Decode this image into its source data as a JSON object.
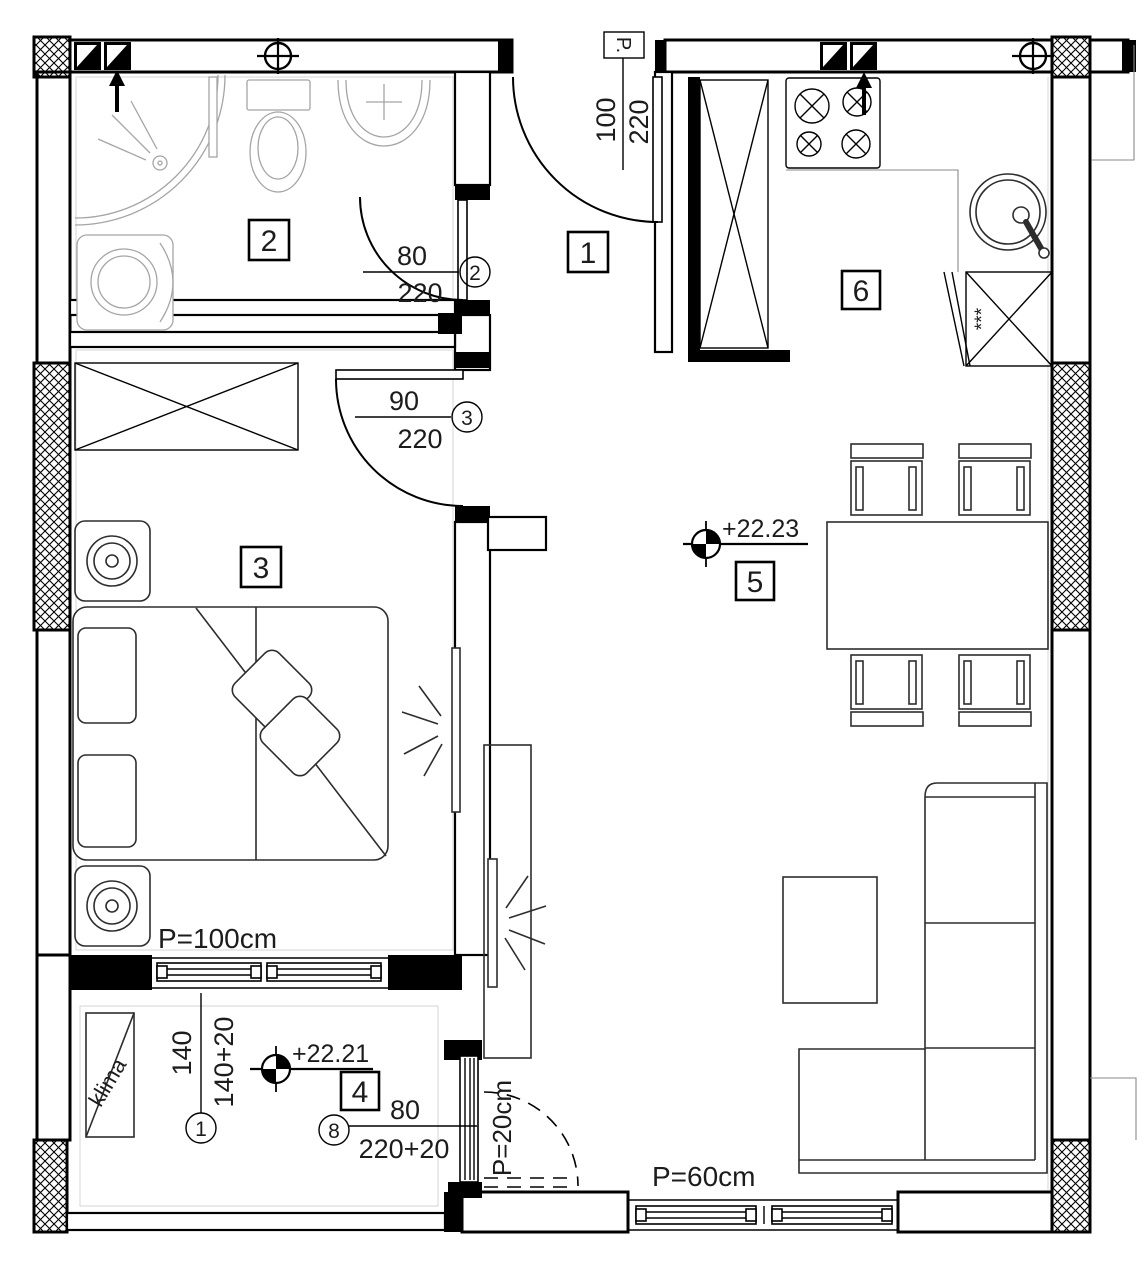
{
  "plan": {
    "rooms": {
      "r1": "1",
      "r2": "2",
      "r3": "3",
      "r4": "4",
      "r5": "5",
      "r6": "6"
    },
    "doors": {
      "entrance": {
        "w": "100",
        "h": "220",
        "tag": "P."
      },
      "bathroom": {
        "w": "80",
        "h": "220",
        "mark": "2"
      },
      "bedroom": {
        "w": "90",
        "h": "220",
        "mark": "3"
      },
      "balcony": {
        "w": "80",
        "h": "220+20",
        "mark": "8"
      }
    },
    "balcony_window": {
      "w": "140",
      "h": "140+20",
      "mark": "1"
    },
    "levels": {
      "living": "+22.23",
      "balcony": "+22.21"
    },
    "parapets": {
      "bedroom": "P=100cm",
      "balcony": "P=20cm",
      "living": "P=60cm"
    },
    "misc": {
      "ac": "klima",
      "stars": "***"
    }
  }
}
